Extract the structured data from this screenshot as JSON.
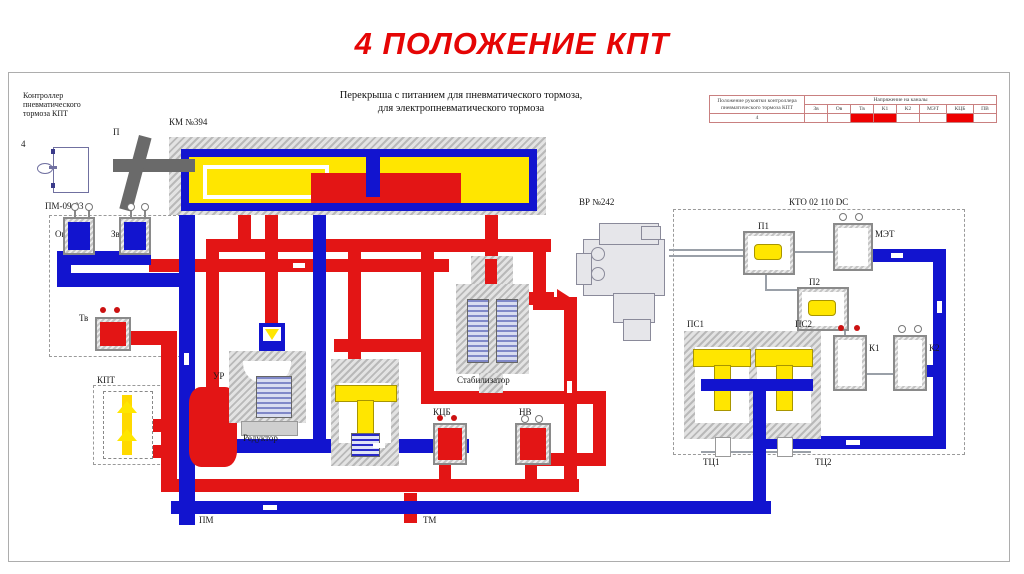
{
  "page": {
    "title": "4 ПОЛОЖЕНИЕ КПТ"
  },
  "colors": {
    "pipe_red": "#e31515",
    "pipe_blue": "#1214cf",
    "accent_yellow": "#ffe600",
    "title_red": "#e50505"
  },
  "diagram": {
    "subtitle_line1": "Перекрыша с питанием для пневматического тормоза,",
    "subtitle_line2": "для электропневматического тормоза",
    "controller_caption_line1": "Контроллер",
    "controller_caption_line2": "пневматического",
    "controller_caption_line3": "тормоза КПТ",
    "position_digit": "4",
    "pm0903": "ПМ-09-03",
    "km394": "КМ №394",
    "handle_p": "П",
    "valve_ov": "Ов",
    "valve_zv": "Зв",
    "valve_tv": "Тв",
    "kpt": "КПТ",
    "ur": "УР",
    "reduktor": "Редуктор",
    "stabilizator": "Стабилизатор",
    "kcb": "КЦБ",
    "nv": "НВ",
    "vr242": "ВР №242",
    "kto": "КТО 02 110 DC",
    "p1": "П1",
    "p2": "П2",
    "met": "МЭТ",
    "ps1": "ПС1",
    "ps2": "ПС2",
    "k1": "К1",
    "k2": "К2",
    "tc1": "ТЦ1",
    "tc2": "ТЦ2",
    "pm": "ПМ",
    "tm": "ТМ"
  },
  "table": {
    "header_left_line1": "Положение рукоятки контроллера",
    "header_left_line2": "пневматического тормоза КПТ",
    "header_right": "Напряжение на каналы",
    "columns": [
      "Зв",
      "Ов",
      "Тв",
      "К1",
      "К2",
      "МЭТ",
      "КЦБ",
      "ПВ"
    ],
    "row_position": "4",
    "energized": [
      "Тв",
      "К1",
      "КЦБ"
    ]
  }
}
